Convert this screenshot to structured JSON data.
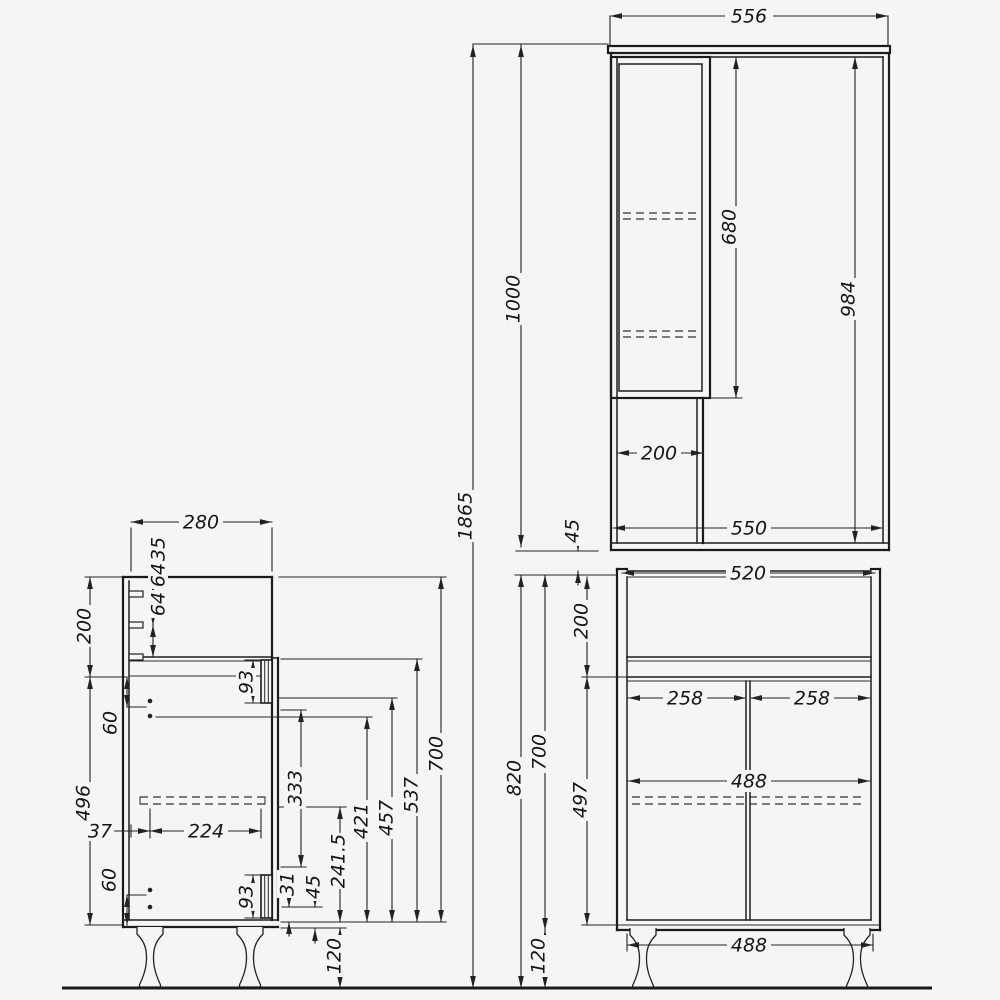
{
  "drawing_title": "cabinet-technical-drawing",
  "dims": {
    "total_height": "1865",
    "gap_units": "45",
    "upper": {
      "width": "556",
      "height": "1000",
      "glass_door_height": "680",
      "interior_height": "984",
      "column_width": "200",
      "interior_width": "550"
    },
    "side": {
      "depth": "280",
      "pin_top_offset": "35",
      "pin_gap_1": "64",
      "pin_gap_2": "64",
      "top_section": "200",
      "pin_offset_top": "60",
      "lower_section": "496",
      "rail_back_offset": "37",
      "rail_length": "224",
      "hinge_top": "93",
      "hinge_bottom": "93",
      "pin_offset_bottom": "60",
      "hinge_edge_offset": "31",
      "bottom_edge_offset": "45",
      "rail_height": "241.5",
      "h333": "333",
      "h421": "421",
      "h457": "457",
      "h537": "537",
      "body_height": "700",
      "leg_height": "120"
    },
    "lower": {
      "width": "520",
      "top_section": "200",
      "door_left": "258",
      "door_right": "258",
      "interior_width": "488",
      "door_height": "497",
      "body_height": "700",
      "total_height": "820",
      "leg_span": "488",
      "leg_height": "120"
    }
  }
}
